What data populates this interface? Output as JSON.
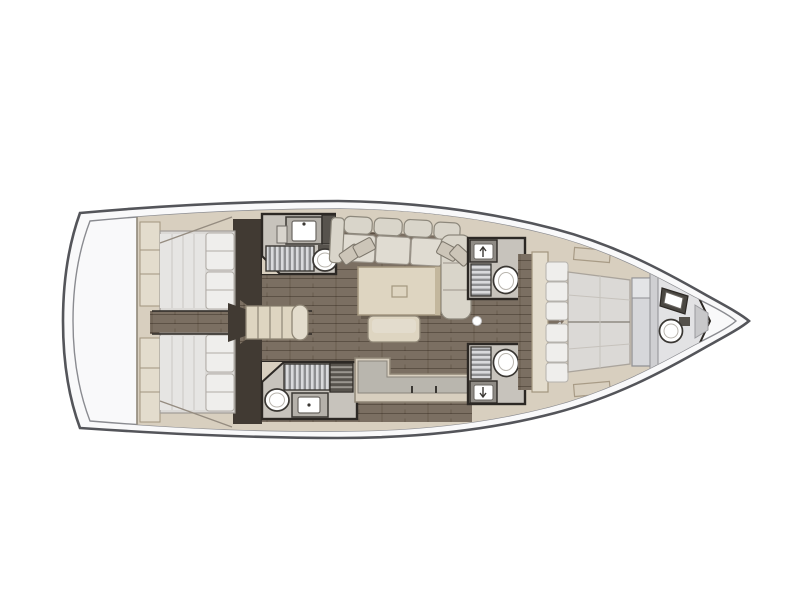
{
  "diagram": {
    "type": "yacht-interior-floor-plan",
    "orientation": "bow-right",
    "rooms": [
      {
        "id": "aft-deck",
        "label": "aft deck"
      },
      {
        "id": "aft-cabin-port",
        "label": "aft double cabin port",
        "fixtures": [
          "double-berth",
          "pillows",
          "wardrobe"
        ]
      },
      {
        "id": "aft-cabin-starboard",
        "label": "aft double cabin starboard",
        "fixtures": [
          "double-berth",
          "pillows",
          "wardrobe"
        ]
      },
      {
        "id": "companionway",
        "label": "companionway steps"
      },
      {
        "id": "head-aft-port",
        "label": "aft head port",
        "fixtures": [
          "sink",
          "shower-grate",
          "toilet",
          "cabinet"
        ]
      },
      {
        "id": "head-aft-starboard",
        "label": "aft head starboard",
        "fixtures": [
          "shower-grate",
          "toilet",
          "sink"
        ]
      },
      {
        "id": "salon",
        "label": "salon",
        "fixtures": [
          "u-shaped-sofa",
          "throw-pillows",
          "dining-table",
          "stool-bench"
        ]
      },
      {
        "id": "galley",
        "label": "galley",
        "fixtures": [
          "l-shaped-counter",
          "drawer-handles"
        ]
      },
      {
        "id": "head-mid-port",
        "label": "mid head port",
        "fixtures": [
          "sink",
          "shower-grate",
          "toilet"
        ]
      },
      {
        "id": "head-mid-starboard",
        "label": "mid head starboard",
        "fixtures": [
          "sink",
          "shower-grate",
          "toilet"
        ]
      },
      {
        "id": "forward-cabin",
        "label": "forward owner cabin",
        "fixtures": [
          "island-double-berth",
          "pillows",
          "foot-bench",
          "deck-hatches"
        ]
      },
      {
        "id": "head-bow",
        "label": "bow head",
        "fixtures": [
          "sink",
          "toilet"
        ]
      }
    ],
    "colors": {
      "canvas": "#ffffff",
      "hull_fill": "#f9f9fa",
      "hull_stroke": "#54555a",
      "inner_line": "#8a8b90",
      "furniture_beige": "#d8cfbf",
      "furniture_beige_light": "#e3dccd",
      "furniture_edge": "#8f8676",
      "floor_brown": "#7b6f62",
      "floor_dark": "#413a33",
      "wall_dark": "#2c2824",
      "room_gray": "#c7c3bc",
      "counter_gray": "#b9b6ae",
      "mattress": "#dbd9d6",
      "duvet": "#e6e5e3",
      "pillow": "#efeeec",
      "sofa": "#d9d5ca",
      "sofa_seat": "#e0dcd2",
      "table": "#ded5c1",
      "table_edge": "#c3b79d",
      "fixture_white": "#ffffff",
      "fixture_stroke": "#3a3733",
      "grate_light": "#d9dadc",
      "grate_dark": "#8e8f91",
      "bench_gray": "#d6d7da"
    }
  }
}
